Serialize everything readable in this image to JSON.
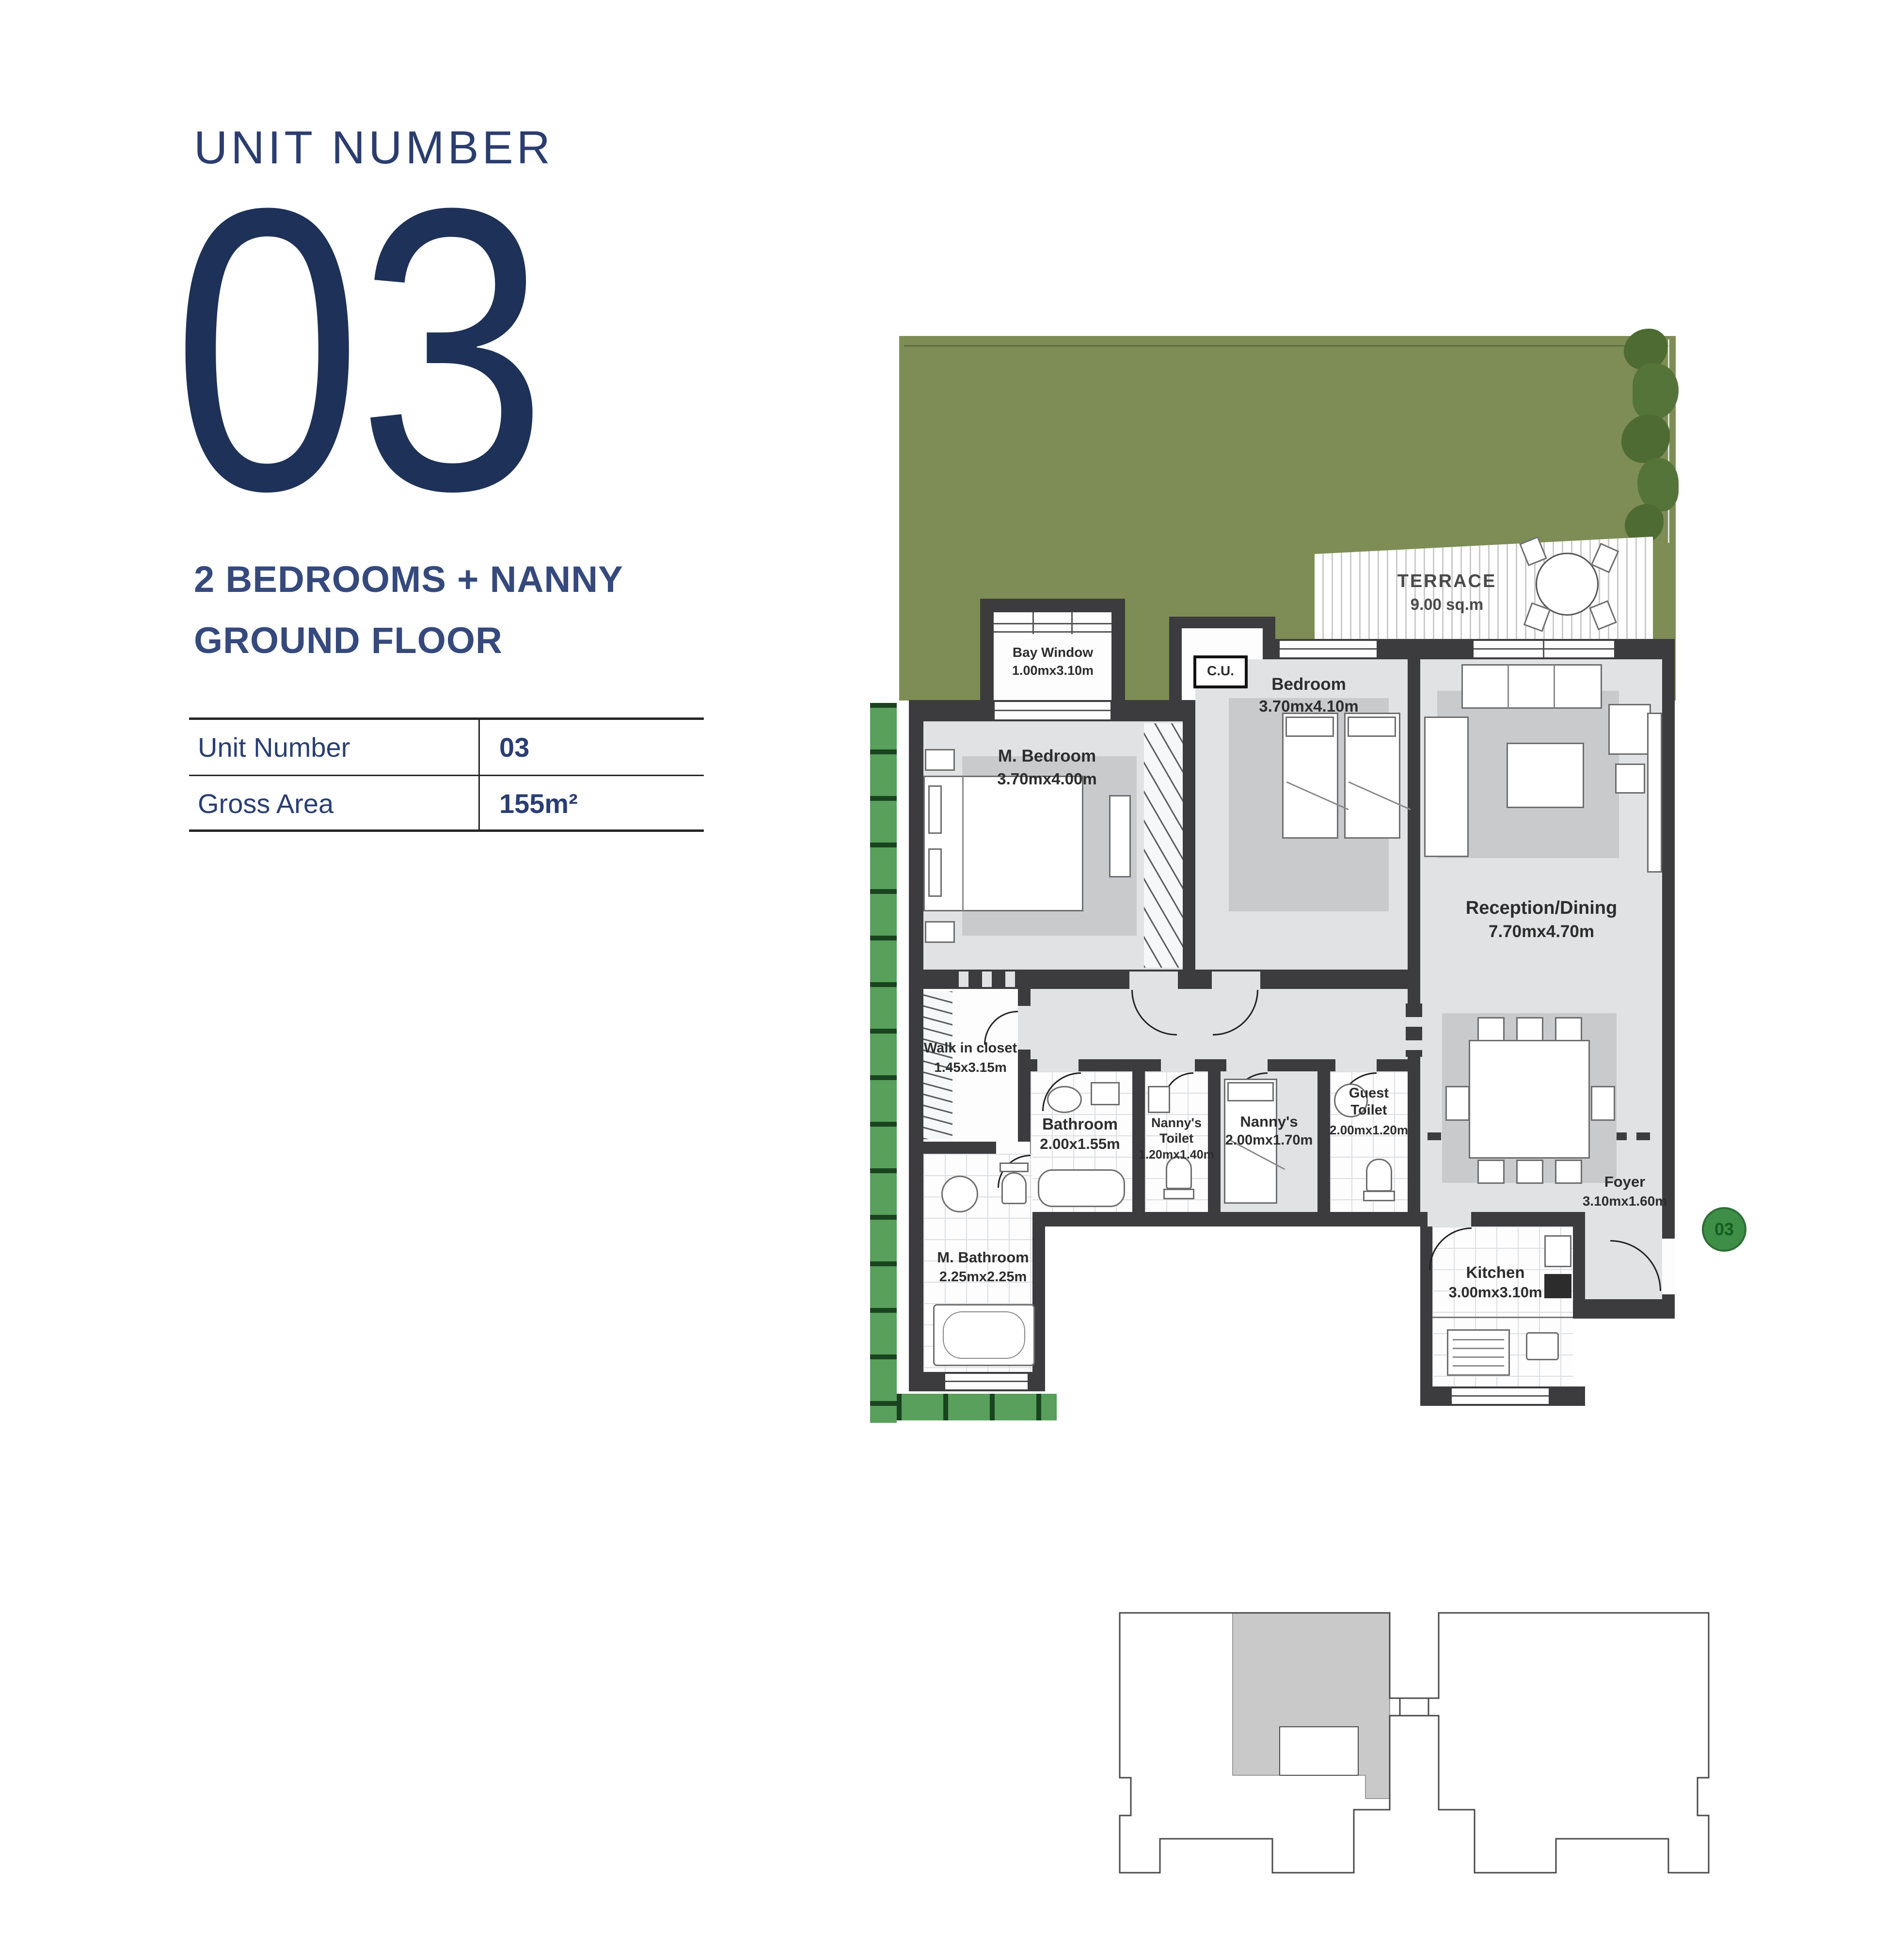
{
  "panel": {
    "title": "UNIT NUMBER",
    "big_number": "03",
    "subtitle1": "2 BEDROOMS + NANNY",
    "subtitle2": "GROUND FLOOR",
    "table": {
      "rows": [
        {
          "label": "Unit Number",
          "value": "03"
        },
        {
          "label": "Gross Area",
          "value": "155m²"
        }
      ]
    }
  },
  "plan": {
    "terrace": {
      "name": "TERRACE",
      "area": "9.00 sq.m"
    },
    "bay_window": {
      "name": "Bay Window",
      "dims": "1.00mx3.10m"
    },
    "cu": {
      "label": "C.U."
    },
    "rooms": {
      "m_bedroom": {
        "name": "M. Bedroom",
        "dims": "3.70mx4.00m"
      },
      "bedroom": {
        "name": "Bedroom",
        "dims": "3.70mx4.10m"
      },
      "reception": {
        "name": "Reception/Dining",
        "dims": "7.70mx4.70m"
      },
      "walk_in_closet": {
        "name": "Walk in closet",
        "dims": "1.45x3.15m"
      },
      "bathroom": {
        "name": "Bathroom",
        "dims": "2.00x1.55m"
      },
      "nannys_toilet": {
        "name": "Nanny's Toilet",
        "dims": "1.20mx1.40m"
      },
      "nannys": {
        "name": "Nanny's",
        "dims": "2.00mx1.70m"
      },
      "guest_toilet": {
        "name": "Guest Toilet",
        "dims": "2.00mx1.20m"
      },
      "m_bathroom": {
        "name": "M. Bathroom",
        "dims": "2.25mx2.25m"
      },
      "kitchen": {
        "name": "Kitchen",
        "dims": "3.00mx3.10m"
      },
      "foyer": {
        "name": "Foyer",
        "dims": "3.10mx1.60m"
      }
    },
    "unit_marker": "03",
    "colors": {
      "garden_green": "#7d8d55",
      "hedge_green": "#58a05b",
      "wall_dark": "#3c3c3e",
      "floor_gray": "#e1e2e4",
      "navy_text": "#2b3d6f",
      "marker_green": "#3e8e47",
      "keyplan_highlight": "#c9c9c9"
    }
  }
}
